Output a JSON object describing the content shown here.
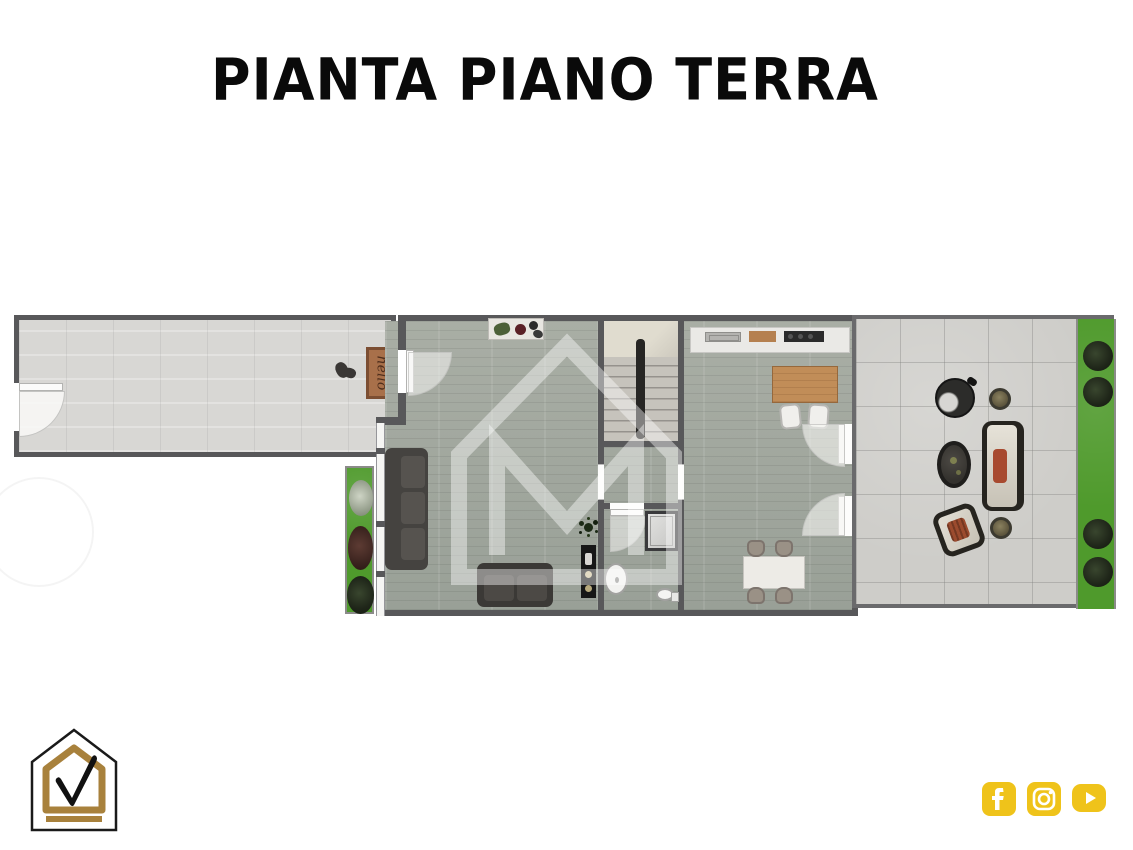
{
  "title": "PIANTA PIANO TERRA",
  "plan": {
    "doormat_text": "hello",
    "watermark_icon": "house-m-watermark"
  },
  "branding": {
    "logo_icon": "house-checkmark-logo",
    "logo_colors": {
      "outline": "#1a1a1a",
      "gold": "#a8813c"
    }
  },
  "social_icons": [
    {
      "name": "facebook-icon"
    },
    {
      "name": "instagram-icon"
    },
    {
      "name": "youtube-icon"
    }
  ],
  "colors": {
    "social_gold": "#efc31a",
    "wall_gray": "#58585a",
    "wood_floor_green_gray": "#a0a59d",
    "garage_concrete": "#d8d7d4",
    "terrace_tile": "#cecdc9",
    "grass_green": "#4f9a2c",
    "island_wood": "#c18d58",
    "doormat_brown": "#a8704a",
    "outdoor_cushion_red": "#a84a2f"
  }
}
